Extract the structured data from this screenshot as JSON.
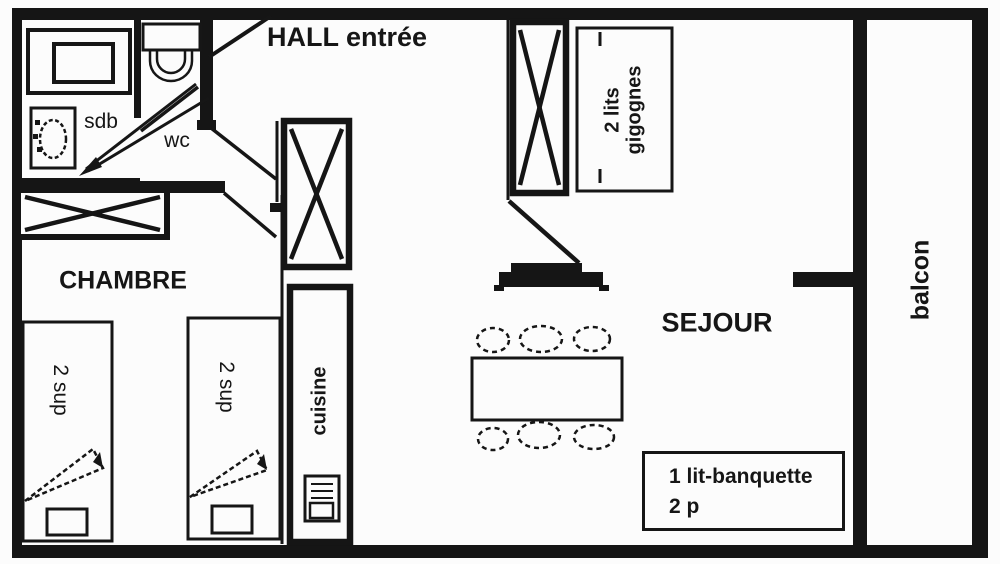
{
  "plan": {
    "type": "apartment-floor-plan",
    "colors": {
      "ink": "#161616",
      "background": "#fcfcfc"
    }
  },
  "rooms": {
    "hall": "HALL entrée",
    "chambre": "CHAMBRE",
    "sejour": "SEJOUR",
    "balcon": "balcon",
    "cuisine": "cuisine",
    "sdb": "sdb",
    "wc": "wc"
  },
  "furniture": {
    "bed1": "2 sup",
    "bed2": "2 sup",
    "lits_gigognes": {
      "line1": "2 lits",
      "line2": "gigognes"
    },
    "banquette": {
      "line1": "1 lit-banquette",
      "line2": "2 p"
    }
  }
}
